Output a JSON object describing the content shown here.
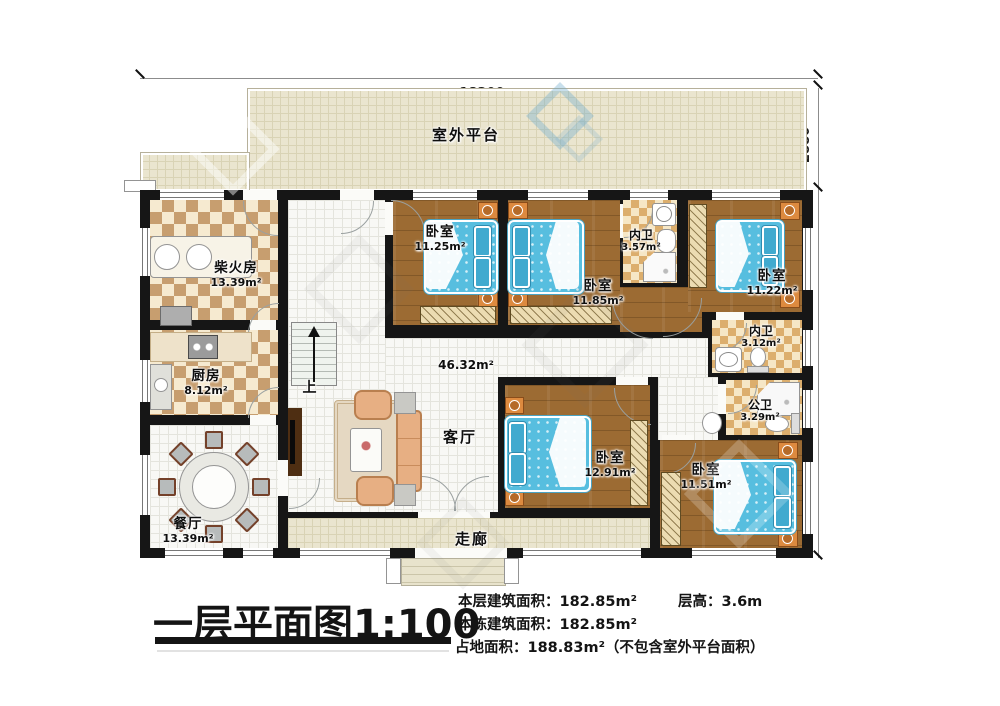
{
  "plan": {
    "scale_title": "一层平面图1:100",
    "outdoor_platform": "室外平台",
    "corridor": "走廊",
    "stairs_up": "上",
    "dims": {
      "top": "18200",
      "platform": "2880",
      "side": "10000"
    },
    "rooms": {
      "firewood": {
        "name": "柴火房",
        "area": "13.39m²"
      },
      "kitchen": {
        "name": "厨房",
        "area": "8.12m²"
      },
      "dining": {
        "name": "餐厅",
        "area": "13.39m²"
      },
      "living": {
        "name": "客厅",
        "area": "46.32m²"
      },
      "bedroom1": {
        "name": "卧室",
        "area": "11.25m²"
      },
      "bedroom2": {
        "name": "卧室",
        "area": "11.85m²"
      },
      "bedroom3": {
        "name": "卧室",
        "area": "11.22m²"
      },
      "bedroom4": {
        "name": "卧室",
        "area": "12.91m²"
      },
      "bedroom5": {
        "name": "卧室",
        "area": "11.51m²"
      },
      "bath_top": {
        "name": "内卫",
        "area": "3.57m²"
      },
      "bath_mid": {
        "name": "内卫",
        "area": "3.12m²"
      },
      "bath_public": {
        "name": "公卫",
        "area": "3.29m²"
      }
    },
    "stats": {
      "floor_area_label": "本层建筑面积：",
      "floor_area": "182.85m²",
      "height_label": "层高：",
      "height": "3.6m",
      "total_area_label": "本栋建筑面积：",
      "total_area": "182.85m²",
      "land_label": "占地面积：",
      "land": "188.83m²（不包含室外平台面积）"
    },
    "colors": {
      "wall": "#161616",
      "wood_floor": "#9c6b33",
      "bed_blue": "#57bedf",
      "checker_tan": "#c79e6f",
      "platform_tile": "#eae5cf"
    }
  }
}
